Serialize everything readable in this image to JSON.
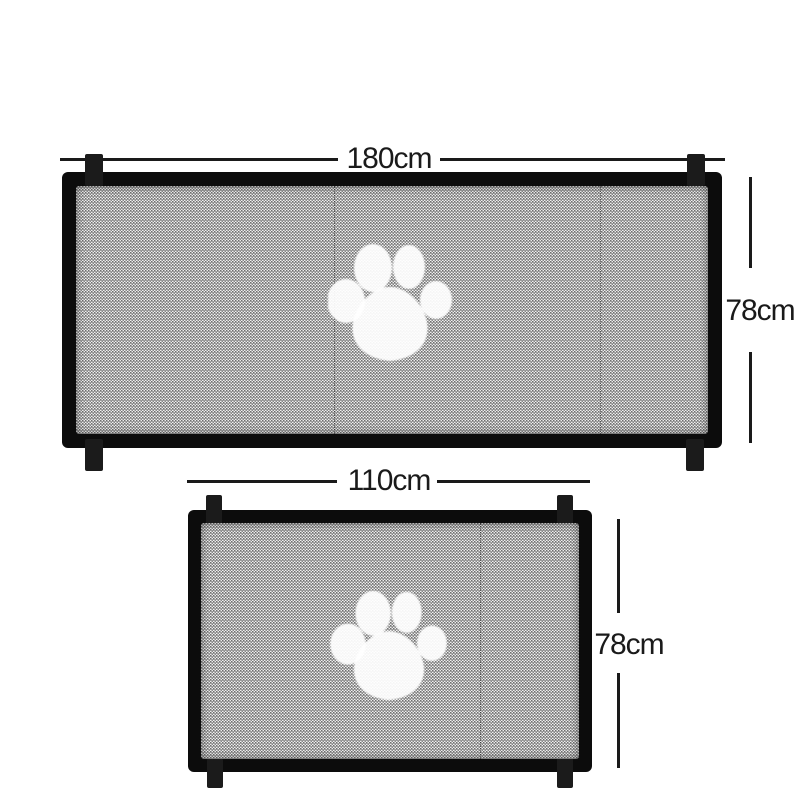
{
  "diagram": {
    "name": "Mesh pet safety gate size diagram",
    "background": "#ffffff",
    "colors": {
      "frame": "#0c0c0c",
      "strap_tab": "#1b1b1b",
      "mesh_light": "#ececec",
      "mesh_dark": "#6e6e6e",
      "dimension_line": "#1a1a1a",
      "label_text": "#1a1a1a",
      "paw_print": "#ffffff"
    },
    "icons": {
      "paw": "paw-print-icon"
    },
    "gates": [
      {
        "id": "large",
        "width_label": "180cm",
        "height_label": "78cm",
        "center_icon": "paw-print"
      },
      {
        "id": "small",
        "width_label": "110cm",
        "height_label": "78cm",
        "center_icon": "paw-print"
      }
    ]
  }
}
